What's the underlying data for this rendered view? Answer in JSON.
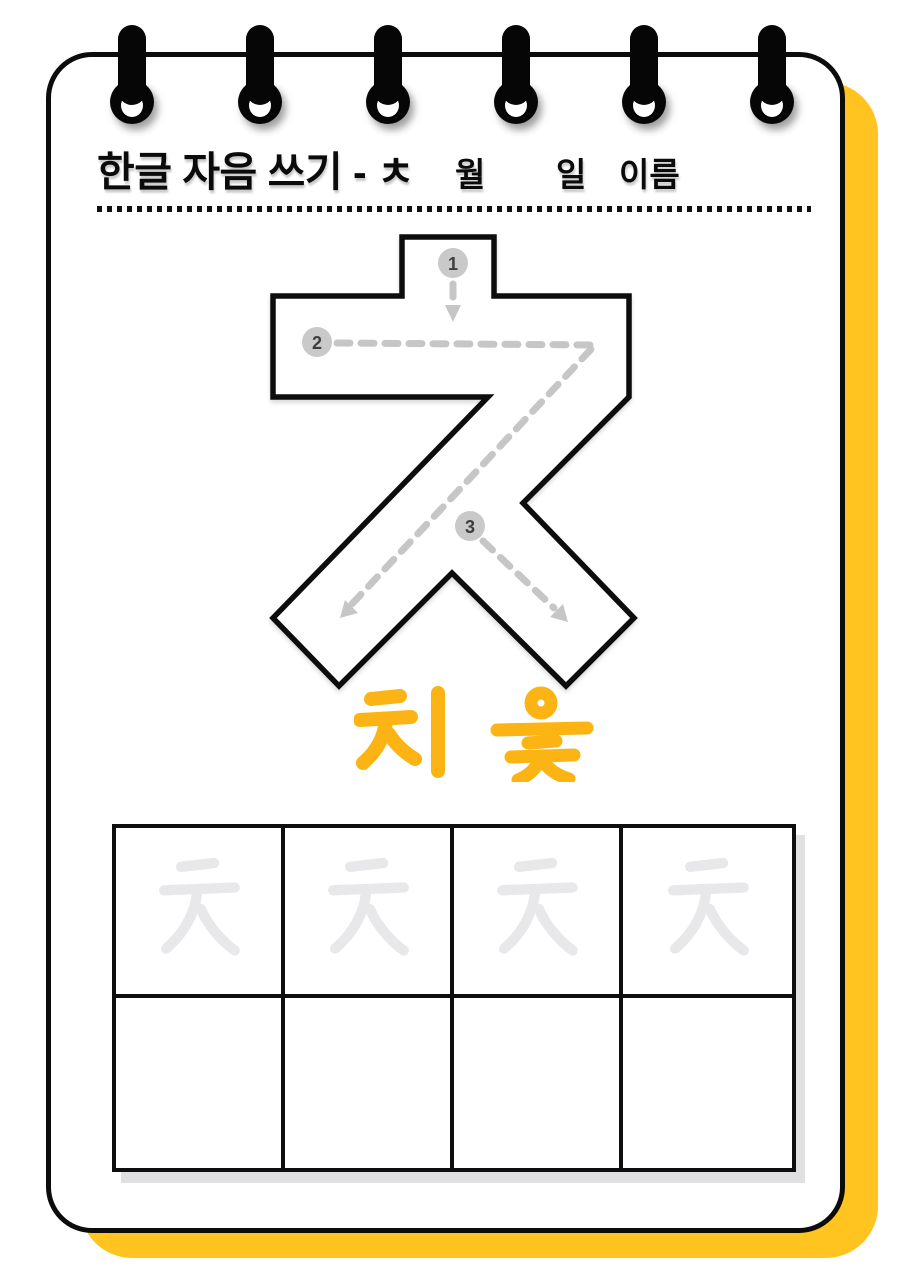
{
  "page": {
    "background": "#ffffff",
    "accent_yellow": "#FFC41F",
    "border_color": "#0c0c0c",
    "ring_count": 6
  },
  "header": {
    "title": "한글 자음 쓰기 - ㅊ",
    "month_label": "월",
    "day_label": "일",
    "name_label": "이름"
  },
  "tracing": {
    "letter": "ㅊ",
    "outline_color": "#0d0d0d",
    "guide_color": "#c6c6c6",
    "marker_fill": "#c9c9c9",
    "stroke_markers": [
      {
        "number": "1",
        "direction": "down"
      },
      {
        "number": "2",
        "direction": "right then down-left"
      },
      {
        "number": "3",
        "direction": "down-right"
      }
    ]
  },
  "pronunciation": {
    "text": "치 읓",
    "color": "#FCB415"
  },
  "practice_grid": {
    "columns": 4,
    "rows": 2,
    "ghost_letter": "ㅊ",
    "ghost_color": "#E8E8EA",
    "ghost_row": "top row traced, bottom row empty"
  }
}
